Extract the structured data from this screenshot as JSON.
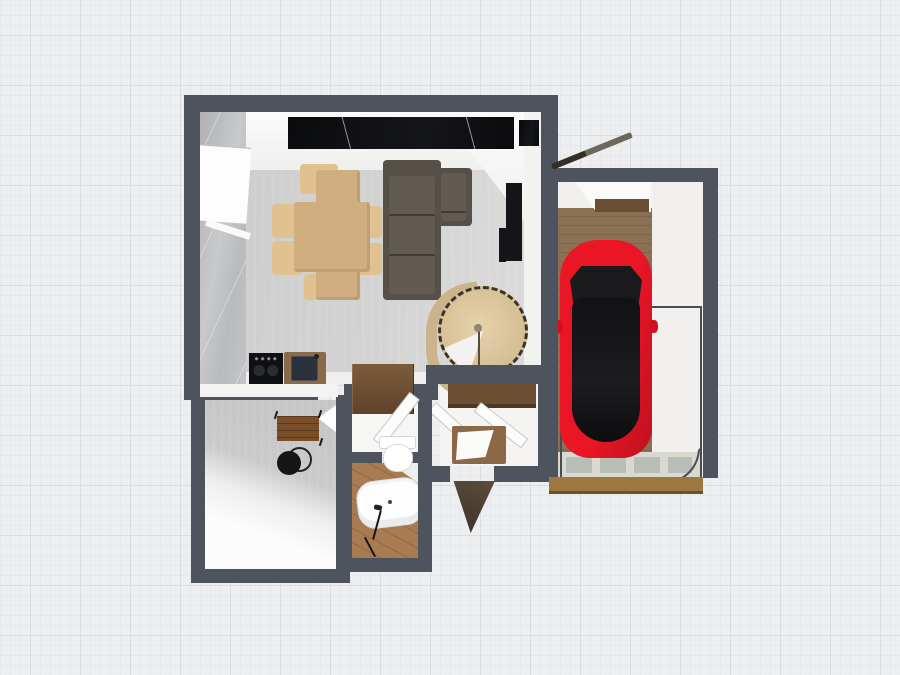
{
  "canvas": {
    "type": "floor-plan-3d-top-down-render",
    "background": "grid-paper",
    "visible_text": ""
  },
  "palette": {
    "grid_bg": "#edeef0",
    "grid_minor": "#e6e8eb",
    "grid_major": "#d9dde3",
    "wall": "#4e545e",
    "lr_floor": "#d2d1d1",
    "marble_wall": "#bcbec0",
    "white_surface": "#f5f5f4",
    "counter_black": "#0d0e10",
    "dining_table_wood": "#cfae80",
    "dining_chair_wood": "#e2c190",
    "sofa": "#575049",
    "tv_black": "#141519",
    "stair_wood": "#d8c39b",
    "stair_arch": "#cbb48b",
    "stair_pole": "#8f8676",
    "cooktop": "#0f1013",
    "sink_frame": "#8a6a48",
    "sink_basin": "#2b313b",
    "garage_wood": "#8b7053",
    "beam_wood": "#6b4f35",
    "car_red": "#e31424",
    "car_glass": "#17171a",
    "tile_band": "#d9d9d0",
    "tile_cell": "#9aa8a2",
    "threshold_wood": "#9c7840",
    "hall_floor": "#f6f6f5",
    "wardrobe_wood": "#6f5236",
    "toilet_white": "#ffffff",
    "bath_wood": "#a87b52",
    "tub_white": "#fdfdfd",
    "desk_wood": "#7a4e28",
    "office_chair_black": "#161616",
    "entry_table_wood": "#8a6848",
    "door_leaf_white": "#fbfbfa",
    "door_dark": "#4a4038",
    "thin_outline": "#474c55"
  },
  "scene": {
    "rooms": [
      {
        "name": "living-room"
      },
      {
        "name": "garage"
      },
      {
        "name": "office"
      },
      {
        "name": "hallway"
      },
      {
        "name": "bathroom"
      },
      {
        "name": "entry"
      }
    ],
    "furniture": [
      "dining-table",
      "dining-chairs",
      "sectional-sofa",
      "tv-panel",
      "spiral-staircase",
      "kitchen-cabinets",
      "cooktop",
      "kitchen-sink",
      "sports-car",
      "garage-threshold",
      "wardrobe",
      "toilet",
      "bathtub",
      "shower-handle",
      "desk",
      "office-chair",
      "entry-table",
      "door-leaves",
      "window"
    ]
  }
}
